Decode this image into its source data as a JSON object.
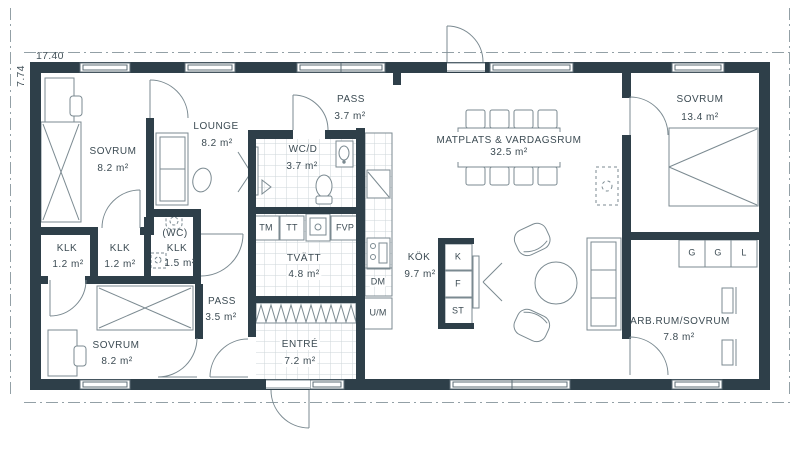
{
  "plan_title": "floor-plan",
  "colors": {
    "wall": "#2e3f49",
    "line": "#7b8a91",
    "text": "#3c4b53"
  },
  "dim": {
    "w": "17.40",
    "h": "7.74"
  },
  "rooms": {
    "sovrum_nw": {
      "name": "SOVRUM",
      "area": "8.2 m²"
    },
    "lounge": {
      "name": "LOUNGE",
      "area": "8.2 m²"
    },
    "pass_n": {
      "name": "PASS",
      "area": "3.7 m²"
    },
    "wcd": {
      "name": "WC/D",
      "area": "3.7 m²"
    },
    "matplats": {
      "name": "MATPLATS & VARDAGSRUM",
      "area": "32.5 m²"
    },
    "sovrum_ne": {
      "name": "SOVRUM",
      "area": "13.4 m²"
    },
    "klk1": {
      "name": "KLK",
      "area": "1.2 m²"
    },
    "klk2": {
      "name": "KLK",
      "area": "1.2 m²"
    },
    "wc_klk": {
      "line1": "(WC)",
      "line2": "KLK",
      "area": "1.5 m²"
    },
    "tvatt": {
      "name": "TVÄTT",
      "area": "4.8 m²"
    },
    "kok": {
      "name": "KÖK",
      "area": "9.7 m²"
    },
    "pass_s": {
      "name": "PASS",
      "area": "3.5 m²"
    },
    "sovrum_sw": {
      "name": "SOVRUM",
      "area": "8.2 m²"
    },
    "entre": {
      "name": "ENTRÉ",
      "area": "7.2 m²"
    },
    "arbrum": {
      "name": "ARB.RUM/SOVRUM",
      "area": "7.8 m²"
    }
  },
  "appliances": {
    "tm": "TM",
    "tt": "TT",
    "fvp": "FVP",
    "dm": "DM",
    "um": "U/M",
    "k": "K",
    "f": "F",
    "st": "ST",
    "g1": "G",
    "g2": "G",
    "l": "L"
  }
}
